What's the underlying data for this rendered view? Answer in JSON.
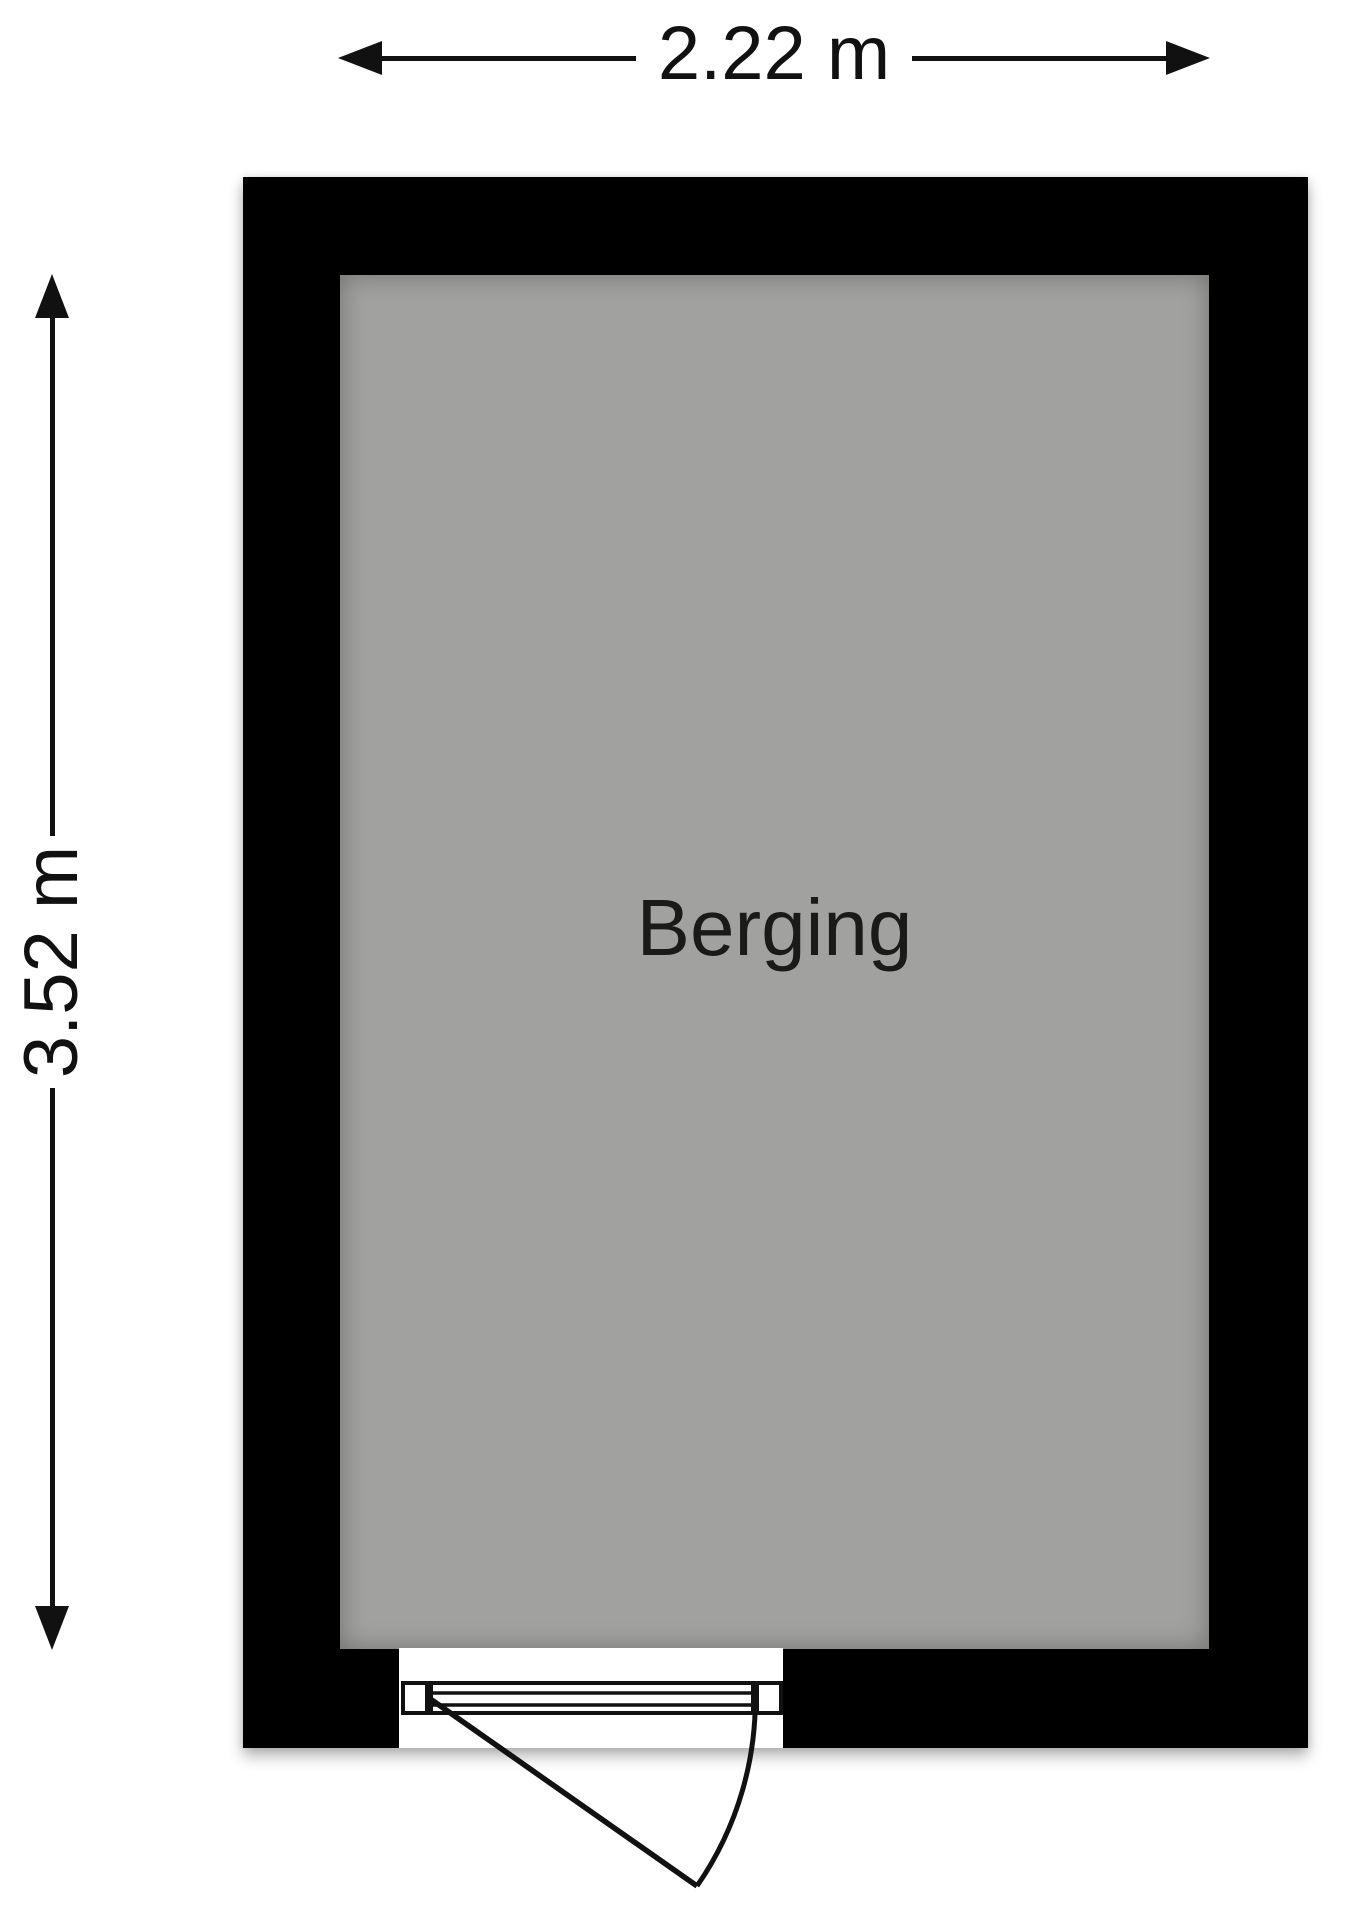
{
  "floorplan": {
    "background_color": "#ffffff",
    "wall_color": "#000000",
    "floor_color": "#a1a19f",
    "line_color": "#111111",
    "room": {
      "label": "Berging"
    },
    "dimensions": {
      "width": {
        "label": "2.22 m",
        "meters": 2.22,
        "orientation": "horizontal"
      },
      "height": {
        "label": "3.52 m",
        "meters": 3.52,
        "orientation": "vertical"
      }
    },
    "door": {
      "wall": "bottom",
      "symbol": "single-swing-door"
    },
    "icons": {
      "arrow_left": "filled-triangle",
      "arrow_right": "filled-triangle",
      "arrow_up": "filled-triangle",
      "arrow_down": "filled-triangle"
    }
  }
}
